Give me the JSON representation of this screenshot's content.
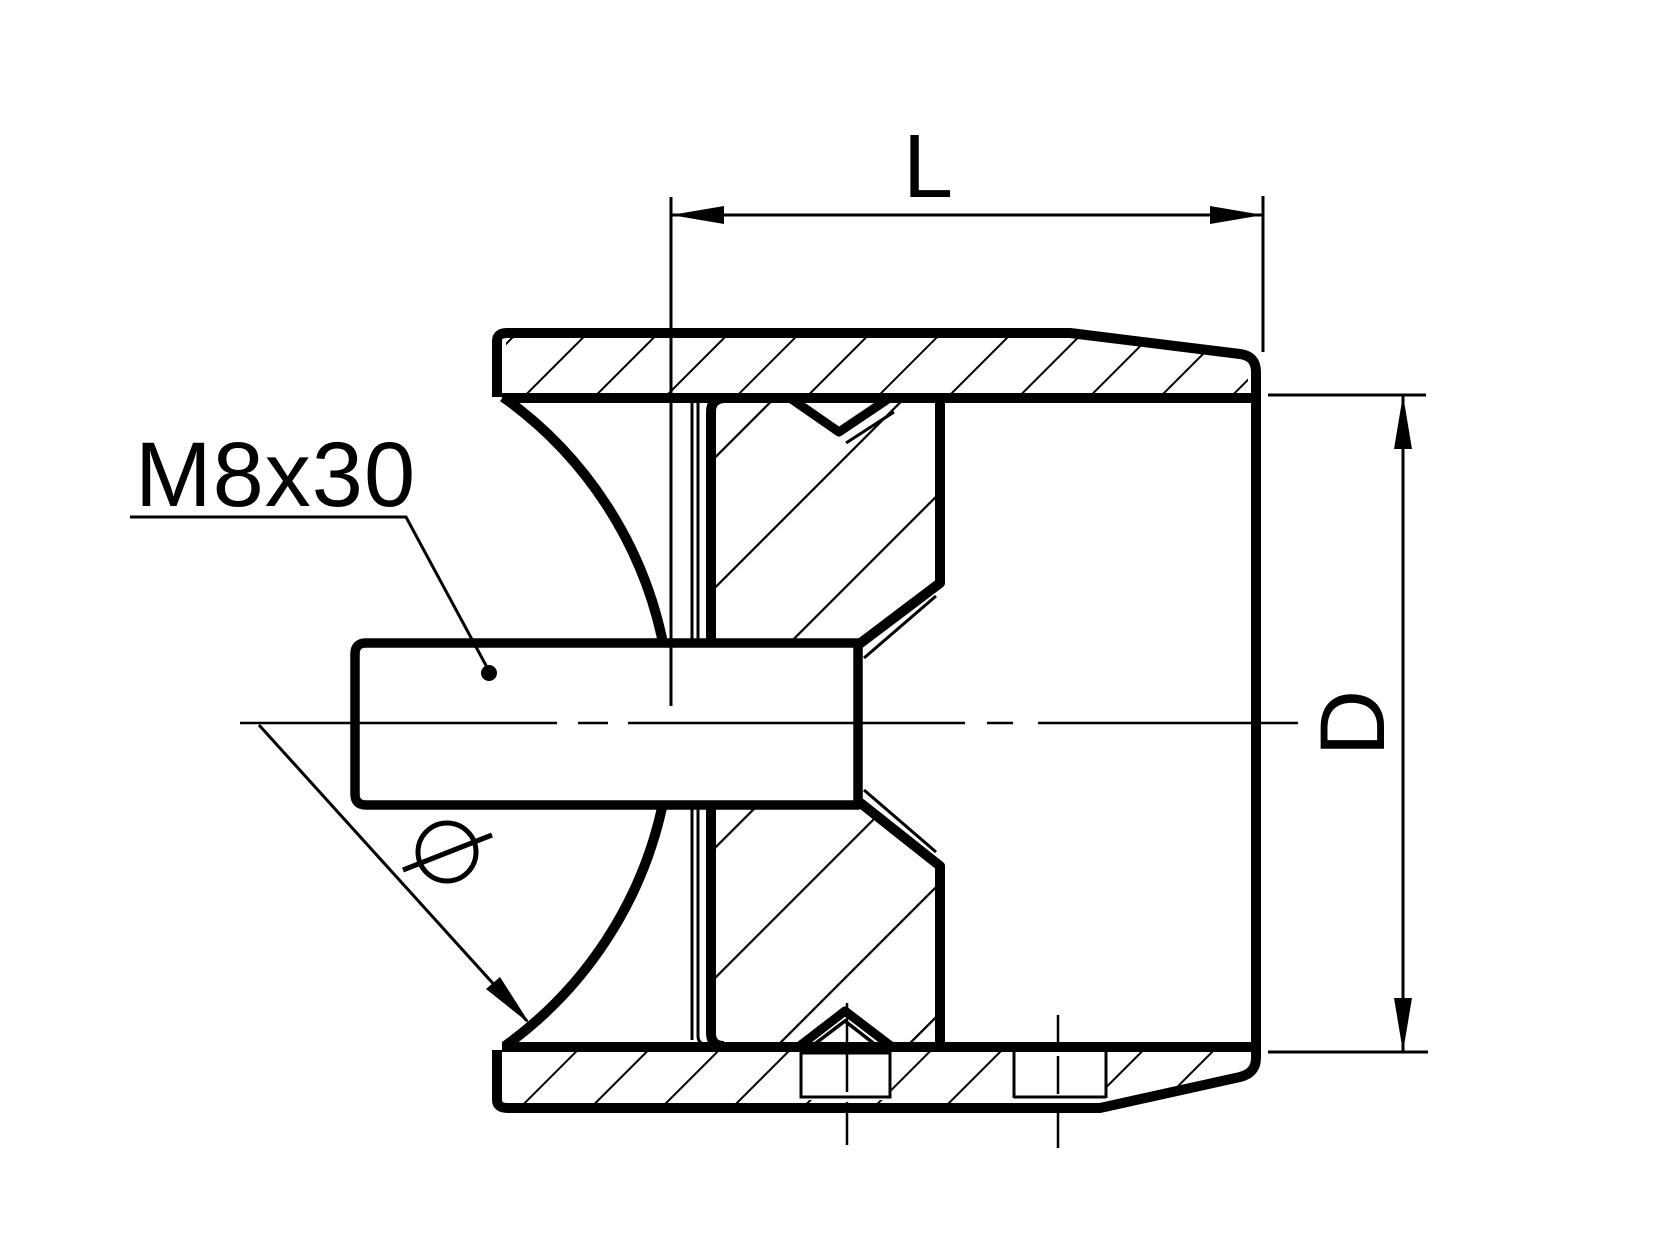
{
  "drawing": {
    "title": "tube adapter cross-section",
    "thread_label": "M8x30",
    "length_label": "L",
    "diameter_label": "D",
    "saddle_diameter_symbol": "Ø",
    "ink_color": "#000000",
    "background_color": "#ffffff"
  }
}
